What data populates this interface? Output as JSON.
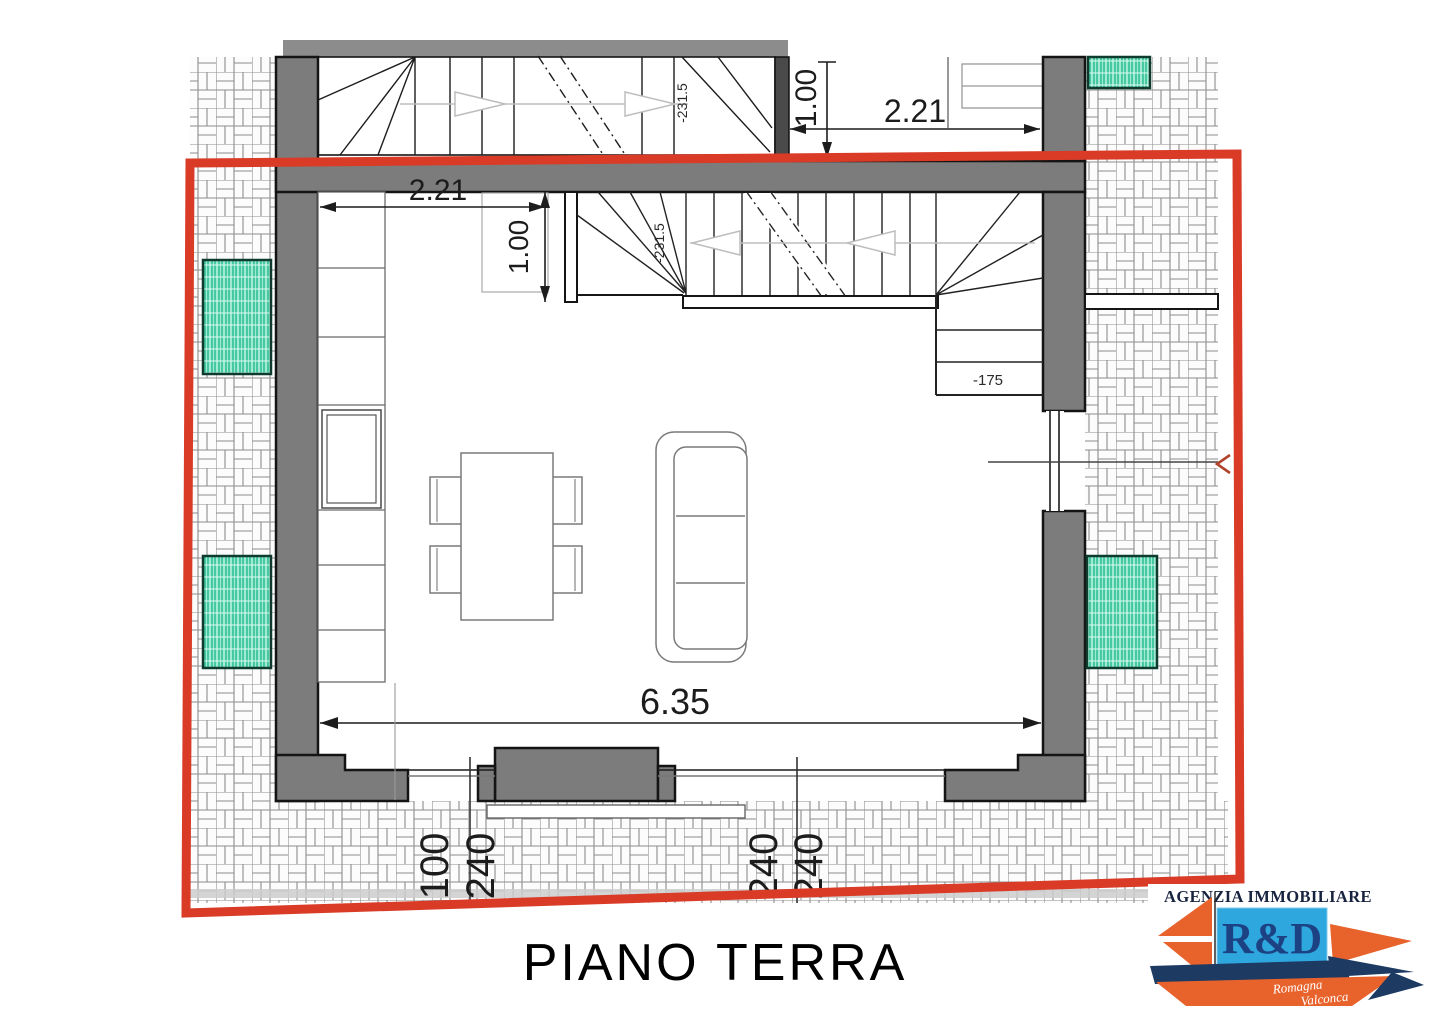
{
  "floor_title": "PIANO TERRA",
  "dimensions": {
    "upper_flight_width": "2.21",
    "upper_flight_depth": "1.00",
    "hall_width": "2.21",
    "hall_depth": "1.00",
    "living_room_width": "6.35",
    "site_offsets": [
      "100",
      "240",
      "240",
      "240"
    ]
  },
  "levels": {
    "upper_stair_cut": "-231.5",
    "ground_stair_cut": "-231.5",
    "entry_landing": "-175"
  },
  "logo": {
    "agency_line": "AGENZIA IMMOBILIARE",
    "initials": "R&D",
    "signature": [
      "Romagna",
      "Valconca"
    ]
  },
  "colors": {
    "selection_red": "#d93b27",
    "wall_gray": "#7c7c7c",
    "paving_line": "#8d8d8d",
    "planter_teal": "#9fead0",
    "planter_stripe": "#2fbf96",
    "logo_orange": "#e8632c",
    "logo_navy": "#1d3a63",
    "logo_blue": "#2ea7de",
    "logo_text": "#17233f"
  }
}
